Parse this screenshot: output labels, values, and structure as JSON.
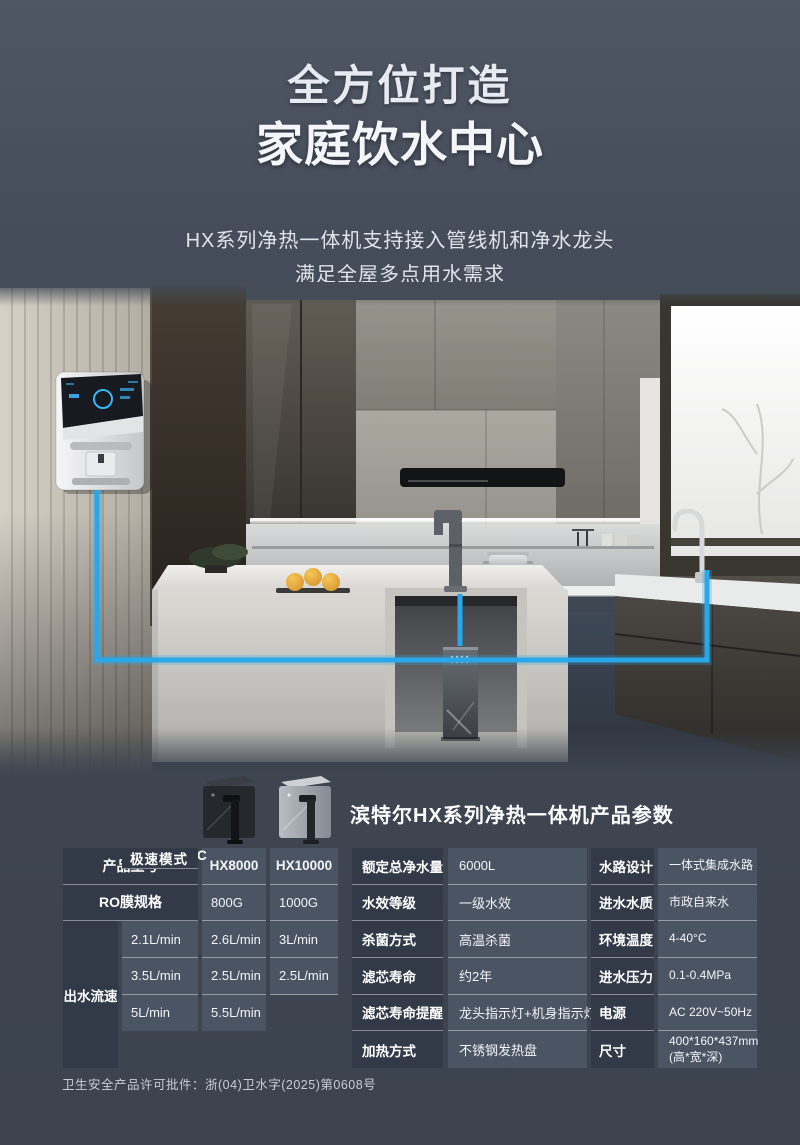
{
  "colors": {
    "accent_blue": "#2aa7e8",
    "label_cell": "#323a47",
    "value_cell": "#4b5462"
  },
  "header": {
    "title_line1": "全方位打造",
    "title_line2": "家庭饮水中心",
    "subtitle_line1": "HX系列净热一体机支持接入管线机和净水龙头",
    "subtitle_line2": "满足全屋多点用水需求"
  },
  "scene": {
    "elements": [
      "wall-mounted-dispenser",
      "island-faucet",
      "under-counter-purifier",
      "sink-faucet",
      "blue-water-line"
    ]
  },
  "specs": {
    "section_title": "滨特尔HX系列净热一体机产品参数",
    "left_table": {
      "rows": [
        {
          "label": "产品型号",
          "v1": "HX8000",
          "v2": "HX10000"
        },
        {
          "label": "RO膜规格",
          "v1": "800G",
          "v2": "1000G"
        }
      ],
      "flow_group_label": "出水流速",
      "flow_rows": [
        {
          "label": "常温",
          "v1": "2.1L/min",
          "v2": "2.6L/min"
        },
        {
          "label": "50°C",
          "v1": "3L/min",
          "v2": "3.5L/min"
        },
        {
          "label": "75/85/95°C",
          "v1": "2.5L/min",
          "v2": "2.5L/min"
        },
        {
          "label": "极速模式",
          "v1": "5L/min",
          "v2": "5.5L/min"
        }
      ]
    },
    "mid_table": [
      {
        "label": "额定总净水量",
        "value": "6000L"
      },
      {
        "label": "水效等级",
        "value": "一级水效"
      },
      {
        "label": "杀菌方式",
        "value": "高温杀菌"
      },
      {
        "label": "滤芯寿命",
        "value": "约2年"
      },
      {
        "label": "滤芯寿命提醒",
        "value": "龙头指示灯+机身指示灯"
      },
      {
        "label": "加热方式",
        "value": "不锈钢发热盘"
      }
    ],
    "right_table": [
      {
        "label": "水路设计",
        "value": "一体式集成水路"
      },
      {
        "label": "进水水质",
        "value": "市政自来水"
      },
      {
        "label": "环境温度",
        "value": "4-40°C"
      },
      {
        "label": "进水压力",
        "value": "0.1-0.4MPa"
      },
      {
        "label": "电源",
        "value": "AC 220V~50Hz"
      },
      {
        "label": "尺寸",
        "value": "400*160*437mm (高*宽*深)"
      }
    ]
  },
  "footer": {
    "license": "卫生安全产品许可批件：浙(04)卫水字(2025)第0608号"
  }
}
